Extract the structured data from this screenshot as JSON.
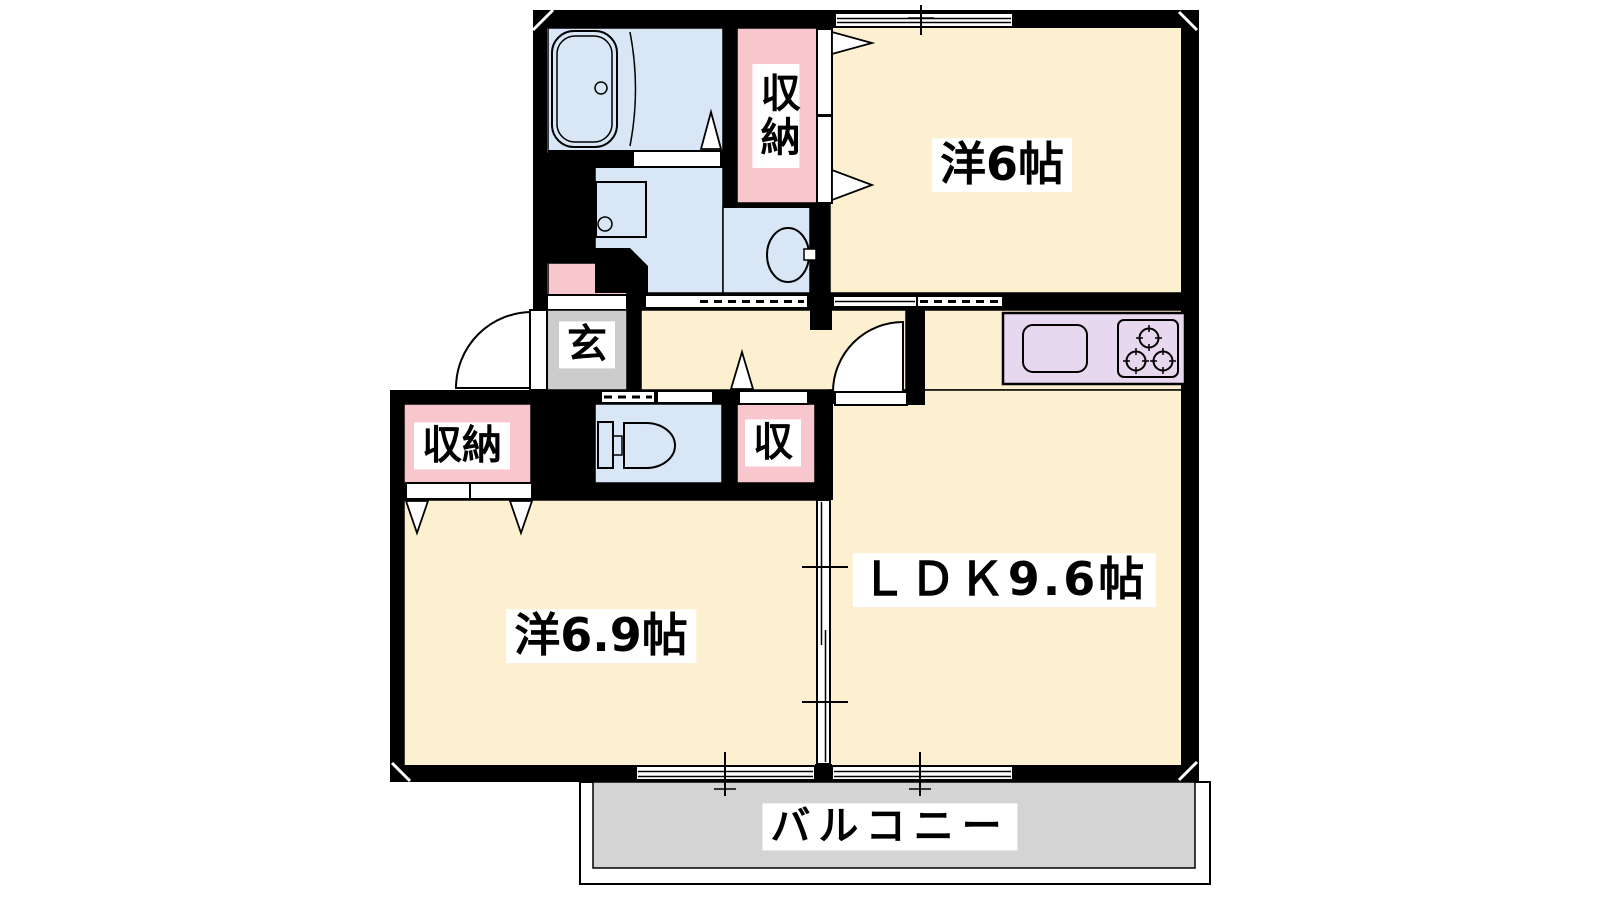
{
  "plan": {
    "labels": {
      "room_west6": "洋6帖",
      "room_ldk": "ＬＤＫ9.6帖",
      "room_west69": "洋6.9帖",
      "balcony": "バルコニー",
      "entrance": "玄",
      "closet_top": "収納",
      "closet_left": "収納",
      "closet_small": "収"
    },
    "colors": {
      "room_floor": "#fdf0d0",
      "wet_area": "#d8e6f6",
      "closet": "#f8c7cd",
      "entrance_floor": "#cccccc",
      "balcony_floor": "#d4d4d4",
      "kitchen_counter": "#e7d8f0",
      "wall": "#000000",
      "background": "#ffffff"
    },
    "fixtures": [
      "bathtub",
      "washing-machine-pan",
      "washbasin",
      "toilet",
      "kitchen-sink",
      "three-burner-stove",
      "entrance-swing-door",
      "ldk-swing-door",
      "balcony-sliding-windows"
    ]
  }
}
